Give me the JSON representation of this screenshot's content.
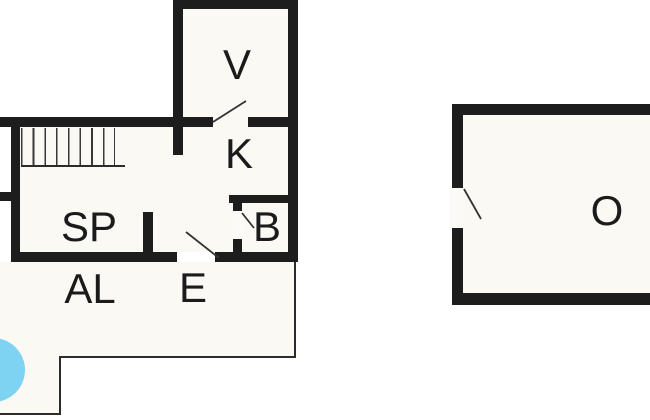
{
  "figure": {
    "type": "floor-plan",
    "description": "Black-and-white architectural floor plan of a house with detached outbuilding, terrace outline and round pool"
  },
  "rooms": [
    {
      "id": "v",
      "label": "V"
    },
    {
      "id": "k",
      "label": "K"
    },
    {
      "id": "sp",
      "label": "SP"
    },
    {
      "id": "b",
      "label": "B"
    },
    {
      "id": "al",
      "label": "AL"
    },
    {
      "id": "e",
      "label": "E"
    },
    {
      "id": "o",
      "label": "O"
    }
  ],
  "stairs": {
    "tread_lines": 9
  },
  "doors": {
    "count": 4
  },
  "colors": {
    "wall": "#1d1d1d",
    "interior": "#faf9f4",
    "thin_line": "#2c2c2c",
    "pool": "#7ed3f2",
    "background": "#ffffff"
  }
}
